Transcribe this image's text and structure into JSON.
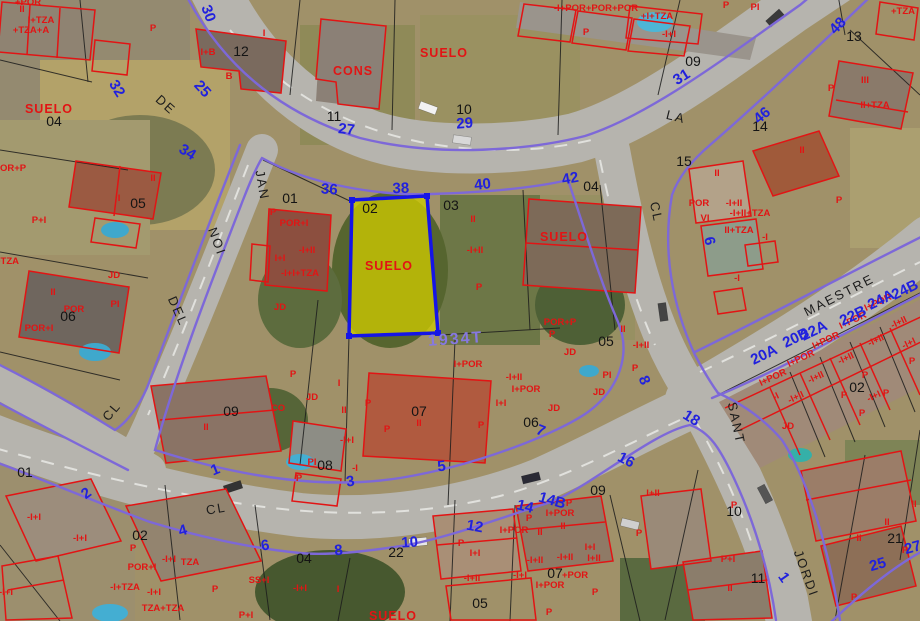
{
  "map_type": "cadastral-aerial-viewer",
  "selected_parcel": {
    "parcel_number": "02",
    "block_id": "1934T",
    "land_label": "SUELO"
  },
  "colors": {
    "highlight_fill": "#cdc900",
    "highlight_border": "#1515e6",
    "street_edge_line": "#7d68d8",
    "construction_outline": "#e21414",
    "parcel_boundary": "#1c1c1c",
    "street_number_text": "#2121dd",
    "parcel_number_text": "#141414",
    "block_id_text": "#8678e0",
    "road_surface": "#b6b4ae"
  },
  "labels": {
    "street_names": [
      {
        "t": "DE",
        "x": 163,
        "y": 108,
        "r": 42
      },
      {
        "t": "JAN",
        "x": 258,
        "y": 186,
        "r": 80
      },
      {
        "t": "NOI",
        "x": 213,
        "y": 243,
        "r": 70
      },
      {
        "t": "DEL",
        "x": 174,
        "y": 313,
        "r": 66
      },
      {
        "t": "LA",
        "x": 675,
        "y": 121,
        "r": 14
      },
      {
        "t": "CL",
        "x": 652,
        "y": 213,
        "r": 78
      },
      {
        "t": "MAESTRE",
        "x": 841,
        "y": 299,
        "r": -27
      },
      {
        "t": "SANT",
        "x": 732,
        "y": 424,
        "r": 78
      },
      {
        "t": "JORDI",
        "x": 802,
        "y": 575,
        "r": 70
      },
      {
        "t": "CL",
        "x": 115,
        "y": 414,
        "r": -50
      },
      {
        "t": "CL",
        "x": 217,
        "y": 513,
        "r": -10
      }
    ],
    "street_numbers": [
      {
        "t": "30",
        "x": 204,
        "y": 15,
        "r": 70
      },
      {
        "t": "32",
        "x": 113,
        "y": 91,
        "r": 58
      },
      {
        "t": "25",
        "x": 199,
        "y": 92,
        "r": 48
      },
      {
        "t": "34",
        "x": 185,
        "y": 156,
        "r": 32
      },
      {
        "t": "27",
        "x": 346,
        "y": 134,
        "r": 6
      },
      {
        "t": "36",
        "x": 329,
        "y": 194,
        "r": 4
      },
      {
        "t": "29",
        "x": 465,
        "y": 128,
        "r": -4
      },
      {
        "t": "38",
        "x": 401,
        "y": 193,
        "r": -2
      },
      {
        "t": "40",
        "x": 483,
        "y": 189,
        "r": -6
      },
      {
        "t": "42",
        "x": 571,
        "y": 183,
        "r": -10
      },
      {
        "t": "31",
        "x": 684,
        "y": 81,
        "r": -32
      },
      {
        "t": "46",
        "x": 765,
        "y": 119,
        "r": -40
      },
      {
        "t": "48",
        "x": 841,
        "y": 29,
        "r": -46
      },
      {
        "t": "6",
        "x": 705,
        "y": 242,
        "r": 78
      },
      {
        "t": "8",
        "x": 640,
        "y": 382,
        "r": 68
      },
      {
        "t": "1",
        "x": 217,
        "y": 474,
        "r": -22
      },
      {
        "t": "2",
        "x": 89,
        "y": 497,
        "r": -36
      },
      {
        "t": "3",
        "x": 351,
        "y": 486,
        "r": -8
      },
      {
        "t": "4",
        "x": 184,
        "y": 535,
        "r": -16
      },
      {
        "t": "5",
        "x": 442,
        "y": 471,
        "r": -6
      },
      {
        "t": "6",
        "x": 266,
        "y": 550,
        "r": -10
      },
      {
        "t": "7",
        "x": 539,
        "y": 435,
        "r": 22
      },
      {
        "t": "8",
        "x": 339,
        "y": 555,
        "r": -6
      },
      {
        "t": "10",
        "x": 410,
        "y": 547,
        "r": -4
      },
      {
        "t": "12",
        "x": 474,
        "y": 531,
        "r": 10
      },
      {
        "t": "14",
        "x": 524,
        "y": 511,
        "r": 14
      },
      {
        "t": "14B",
        "x": 551,
        "y": 505,
        "r": 16
      },
      {
        "t": "16",
        "x": 624,
        "y": 464,
        "r": 28
      },
      {
        "t": "18",
        "x": 689,
        "y": 422,
        "r": 32
      },
      {
        "t": "20A",
        "x": 766,
        "y": 359,
        "r": -26
      },
      {
        "t": "20B",
        "x": 798,
        "y": 342,
        "r": -26
      },
      {
        "t": "22A",
        "x": 816,
        "y": 335,
        "r": -26
      },
      {
        "t": "22B",
        "x": 855,
        "y": 320,
        "r": -26
      },
      {
        "t": "24A",
        "x": 883,
        "y": 304,
        "r": -26
      },
      {
        "t": "24B",
        "x": 907,
        "y": 294,
        "r": -26
      },
      {
        "t": "25",
        "x": 879,
        "y": 569,
        "r": -16
      },
      {
        "t": "27",
        "x": 914,
        "y": 552,
        "r": -16
      },
      {
        "t": "1",
        "x": 780,
        "y": 580,
        "r": 55
      }
    ],
    "parcel_numbers": [
      {
        "t": "12",
        "x": 241,
        "y": 56
      },
      {
        "t": "04",
        "x": 54,
        "y": 126
      },
      {
        "t": "11",
        "x": 334,
        "y": 121
      },
      {
        "t": "10",
        "x": 464,
        "y": 114
      },
      {
        "t": "09",
        "x": 693,
        "y": 66
      },
      {
        "t": "13",
        "x": 854,
        "y": 41
      },
      {
        "t": "14",
        "x": 760,
        "y": 131
      },
      {
        "t": "04",
        "x": 591,
        "y": 191
      },
      {
        "t": "15",
        "x": 684,
        "y": 166
      },
      {
        "t": "01",
        "x": 290,
        "y": 203
      },
      {
        "t": "02",
        "x": 370,
        "y": 213
      },
      {
        "t": "03",
        "x": 451,
        "y": 210
      },
      {
        "t": "05",
        "x": 138,
        "y": 208
      },
      {
        "t": "06",
        "x": 68,
        "y": 321
      },
      {
        "t": "05",
        "x": 606,
        "y": 346
      },
      {
        "t": "06",
        "x": 531,
        "y": 427
      },
      {
        "t": "07",
        "x": 419,
        "y": 416
      },
      {
        "t": "08",
        "x": 325,
        "y": 470
      },
      {
        "t": "09",
        "x": 231,
        "y": 416
      },
      {
        "t": "01",
        "x": 25,
        "y": 477
      },
      {
        "t": "02",
        "x": 140,
        "y": 540
      },
      {
        "t": "22",
        "x": 396,
        "y": 557
      },
      {
        "t": "04",
        "x": 304,
        "y": 563
      },
      {
        "t": "05",
        "x": 480,
        "y": 608
      },
      {
        "t": "07",
        "x": 555,
        "y": 578
      },
      {
        "t": "09",
        "x": 598,
        "y": 495
      },
      {
        "t": "10",
        "x": 734,
        "y": 516
      },
      {
        "t": "11",
        "x": 758,
        "y": 583
      },
      {
        "t": "21",
        "x": 895,
        "y": 543
      },
      {
        "t": "02",
        "x": 857,
        "y": 392
      }
    ],
    "construction_codes": [
      {
        "t": "II",
        "x": 22,
        "y": 12
      },
      {
        "t": "I+TZA",
        "x": 41,
        "y": 23
      },
      {
        "t": "+TZA+A",
        "x": 31,
        "y": 33
      },
      {
        "t": "+POR",
        "x": 28,
        "y": 5
      },
      {
        "t": "P",
        "x": 153,
        "y": 31
      },
      {
        "t": "I",
        "x": 264,
        "y": 36
      },
      {
        "t": "I+B",
        "x": 208,
        "y": 55
      },
      {
        "t": "B",
        "x": 229,
        "y": 79
      },
      {
        "t": "CONS",
        "x": 353,
        "y": 75,
        "s": "b"
      },
      {
        "t": "SUELO",
        "x": 49,
        "y": 113,
        "s": "b"
      },
      {
        "t": "SUELO",
        "x": 444,
        "y": 57,
        "s": "b"
      },
      {
        "t": "-I+POR+POR+POR",
        "x": 596,
        "y": 11
      },
      {
        "t": "+I+TZA",
        "x": 657,
        "y": 19
      },
      {
        "t": "P",
        "x": 586,
        "y": 35
      },
      {
        "t": "-I+I",
        "x": 669,
        "y": 37
      },
      {
        "t": "P",
        "x": 726,
        "y": 8
      },
      {
        "t": "PI",
        "x": 755,
        "y": 10
      },
      {
        "t": "+TZA",
        "x": 903,
        "y": 14
      },
      {
        "t": "III",
        "x": 865,
        "y": 83
      },
      {
        "t": "II+TZA",
        "x": 875,
        "y": 108
      },
      {
        "t": "P",
        "x": 831,
        "y": 91
      },
      {
        "t": "II",
        "x": 802,
        "y": 153
      },
      {
        "t": "P",
        "x": 839,
        "y": 203
      },
      {
        "t": "OR+P",
        "x": 13,
        "y": 171
      },
      {
        "t": "II",
        "x": 153,
        "y": 181
      },
      {
        "t": "I",
        "x": 119,
        "y": 201
      },
      {
        "t": "P+I",
        "x": 39,
        "y": 223
      },
      {
        "t": "+TZA",
        "x": 7,
        "y": 264
      },
      {
        "t": "II",
        "x": 53,
        "y": 295
      },
      {
        "t": "POR",
        "x": 74,
        "y": 312
      },
      {
        "t": "PI",
        "x": 115,
        "y": 307
      },
      {
        "t": "JD",
        "x": 114,
        "y": 278
      },
      {
        "t": "POR+I",
        "x": 39,
        "y": 331
      },
      {
        "t": "P",
        "x": 273,
        "y": 215
      },
      {
        "t": "POR+I",
        "x": 294,
        "y": 226
      },
      {
        "t": "-I+II",
        "x": 307,
        "y": 253
      },
      {
        "t": "I+I",
        "x": 280,
        "y": 261
      },
      {
        "t": "-I+I+TZA",
        "x": 300,
        "y": 276
      },
      {
        "t": "JD",
        "x": 280,
        "y": 310
      },
      {
        "t": "SUELO",
        "x": 389,
        "y": 270,
        "s": "b"
      },
      {
        "t": "II",
        "x": 473,
        "y": 222
      },
      {
        "t": "-I+II",
        "x": 475,
        "y": 253
      },
      {
        "t": "P",
        "x": 479,
        "y": 290
      },
      {
        "t": "SUELO",
        "x": 564,
        "y": 241,
        "s": "b"
      },
      {
        "t": "POR+P",
        "x": 560,
        "y": 325
      },
      {
        "t": "P",
        "x": 552,
        "y": 337
      },
      {
        "t": "JD",
        "x": 570,
        "y": 355
      },
      {
        "t": "II",
        "x": 717,
        "y": 176
      },
      {
        "t": "POR",
        "x": 699,
        "y": 206
      },
      {
        "t": "-I+II",
        "x": 734,
        "y": 206
      },
      {
        "t": "-I+II+TZA",
        "x": 750,
        "y": 216
      },
      {
        "t": "VI",
        "x": 705,
        "y": 221
      },
      {
        "t": "II+TZA",
        "x": 739,
        "y": 233
      },
      {
        "t": "-I",
        "x": 765,
        "y": 240
      },
      {
        "t": "-I",
        "x": 737,
        "y": 281
      },
      {
        "t": "II",
        "x": 623,
        "y": 332
      },
      {
        "t": "-I+II",
        "x": 641,
        "y": 348
      },
      {
        "t": "PI",
        "x": 607,
        "y": 378
      },
      {
        "t": "P",
        "x": 635,
        "y": 371
      },
      {
        "t": "JD",
        "x": 599,
        "y": 395
      },
      {
        "t": "I+POR",
        "x": 468,
        "y": 367
      },
      {
        "t": "-I+II",
        "x": 514,
        "y": 380
      },
      {
        "t": "I+POR",
        "x": 526,
        "y": 392
      },
      {
        "t": "I+I",
        "x": 501,
        "y": 406
      },
      {
        "t": "JD",
        "x": 554,
        "y": 411
      },
      {
        "t": "P",
        "x": 481,
        "y": 428
      },
      {
        "t": "I",
        "x": 339,
        "y": 386
      },
      {
        "t": "JD",
        "x": 312,
        "y": 400
      },
      {
        "t": "II",
        "x": 344,
        "y": 413
      },
      {
        "t": "P",
        "x": 368,
        "y": 406
      },
      {
        "t": "P",
        "x": 293,
        "y": 377
      },
      {
        "t": "P",
        "x": 387,
        "y": 432
      },
      {
        "t": "-I+I",
        "x": 347,
        "y": 443
      },
      {
        "t": "-I",
        "x": 355,
        "y": 471
      },
      {
        "t": "PI",
        "x": 312,
        "y": 465
      },
      {
        "t": "P",
        "x": 299,
        "y": 481
      },
      {
        "t": "II",
        "x": 419,
        "y": 426
      },
      {
        "t": "CO",
        "x": 278,
        "y": 411
      },
      {
        "t": "II",
        "x": 206,
        "y": 430
      },
      {
        "t": "-I+I",
        "x": 34,
        "y": 520
      },
      {
        "t": "-I+I",
        "x": 80,
        "y": 541
      },
      {
        "t": "P",
        "x": 133,
        "y": 551
      },
      {
        "t": "POR+I",
        "x": 142,
        "y": 570
      },
      {
        "t": "-I+I",
        "x": 169,
        "y": 562
      },
      {
        "t": "TZA",
        "x": 190,
        "y": 565
      },
      {
        "t": "-I+TZA",
        "x": 125,
        "y": 590
      },
      {
        "t": "-I+I",
        "x": 154,
        "y": 595
      },
      {
        "t": "TZA+TZA",
        "x": 163,
        "y": 611
      },
      {
        "t": "P",
        "x": 215,
        "y": 592
      },
      {
        "t": "SS+I",
        "x": 259,
        "y": 583
      },
      {
        "t": "-I+I",
        "x": 300,
        "y": 591
      },
      {
        "t": "P+I",
        "x": 246,
        "y": 618
      },
      {
        "t": "I",
        "x": 338,
        "y": 592
      },
      {
        "t": "-I+I",
        "x": 6,
        "y": 595
      },
      {
        "t": "SUELO",
        "x": 393,
        "y": 620,
        "s": "b"
      },
      {
        "t": "P",
        "x": 461,
        "y": 546
      },
      {
        "t": "I+I",
        "x": 475,
        "y": 556
      },
      {
        "t": "-I+II",
        "x": 472,
        "y": 581
      },
      {
        "t": "I+POR",
        "x": 514,
        "y": 533
      },
      {
        "t": "II",
        "x": 540,
        "y": 535
      },
      {
        "t": "II",
        "x": 563,
        "y": 529
      },
      {
        "t": "I+POR",
        "x": 560,
        "y": 516
      },
      {
        "t": "-I+II",
        "x": 535,
        "y": 563
      },
      {
        "t": "-I+II",
        "x": 565,
        "y": 560
      },
      {
        "t": "-I+I",
        "x": 520,
        "y": 578
      },
      {
        "t": "I+I",
        "x": 590,
        "y": 550
      },
      {
        "t": "I+II",
        "x": 594,
        "y": 561
      },
      {
        "t": "+POR",
        "x": 575,
        "y": 578
      },
      {
        "t": "I+POR",
        "x": 550,
        "y": 588
      },
      {
        "t": "P",
        "x": 529,
        "y": 521
      },
      {
        "t": "P",
        "x": 569,
        "y": 506
      },
      {
        "t": "P",
        "x": 549,
        "y": 615
      },
      {
        "t": "P",
        "x": 595,
        "y": 595
      },
      {
        "t": "I+II",
        "x": 653,
        "y": 496
      },
      {
        "t": "P",
        "x": 734,
        "y": 508
      },
      {
        "t": "P",
        "x": 639,
        "y": 536
      },
      {
        "t": "P+I",
        "x": 728,
        "y": 562
      },
      {
        "t": "II",
        "x": 730,
        "y": 591
      },
      {
        "t": "II",
        "x": 914,
        "y": 507
      },
      {
        "t": "II",
        "x": 887,
        "y": 525
      },
      {
        "t": "II",
        "x": 859,
        "y": 541
      },
      {
        "t": "P",
        "x": 905,
        "y": 553
      },
      {
        "t": "P",
        "x": 854,
        "y": 600
      },
      {
        "t": "I+POR",
        "x": 879,
        "y": 305,
        "r": -25
      },
      {
        "t": "-I+II",
        "x": 900,
        "y": 325,
        "r": -25
      },
      {
        "t": "I+POR",
        "x": 854,
        "y": 323,
        "r": -25
      },
      {
        "t": "I+POR",
        "x": 827,
        "y": 343,
        "r": -25
      },
      {
        "t": "-I+II",
        "x": 877,
        "y": 343,
        "r": -25
      },
      {
        "t": "I+POR",
        "x": 802,
        "y": 361,
        "r": -25
      },
      {
        "t": "-I+II",
        "x": 847,
        "y": 361,
        "r": -25
      },
      {
        "t": "I+POR",
        "x": 774,
        "y": 380,
        "r": -25
      },
      {
        "t": "-I+II",
        "x": 817,
        "y": 380,
        "r": -25
      },
      {
        "t": "-I+II",
        "x": 797,
        "y": 400,
        "r": -25
      },
      {
        "t": "-I",
        "x": 777,
        "y": 399,
        "r": -25
      },
      {
        "t": "-I+I",
        "x": 910,
        "y": 346,
        "r": -25
      },
      {
        "t": "-I+I",
        "x": 875,
        "y": 399,
        "r": -25
      },
      {
        "t": "P",
        "x": 912,
        "y": 364
      },
      {
        "t": "P",
        "x": 865,
        "y": 378
      },
      {
        "t": "P",
        "x": 886,
        "y": 396
      },
      {
        "t": "P",
        "x": 844,
        "y": 398
      },
      {
        "t": "P",
        "x": 862,
        "y": 416
      },
      {
        "t": "JD",
        "x": 788,
        "y": 429
      }
    ],
    "block_ids": [
      {
        "t": "1934T",
        "x": 456,
        "y": 344,
        "r": -4
      }
    ]
  }
}
